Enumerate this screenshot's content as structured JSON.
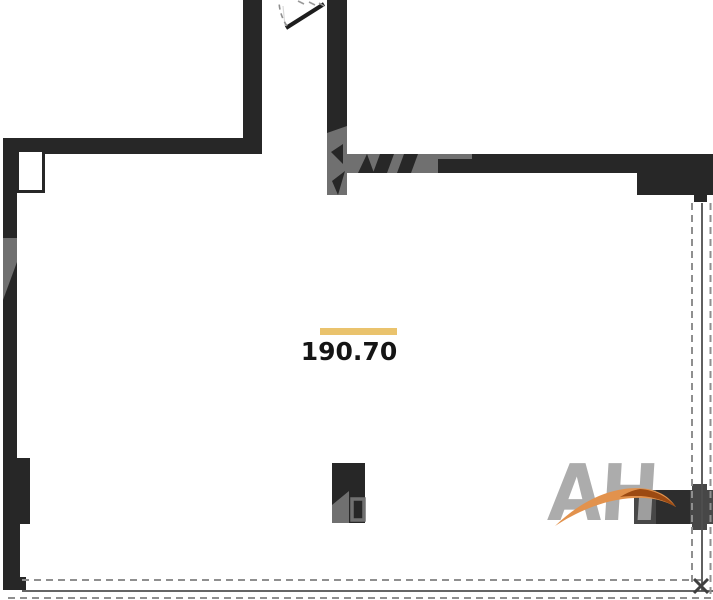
{
  "floor_plan": {
    "area_label": "190.70"
  },
  "logo": {
    "text": "АН"
  },
  "colors": {
    "wall": "#272727",
    "accent-bar": "#eac36d",
    "label-text": "#151515",
    "watermark-gray": "#707070",
    "logo-gray": "#a6a6a6",
    "swoosh-orange": "#e2924d",
    "swoosh-dark": "#9c4a12",
    "dash-gray": "#8f8f8f",
    "glazing-solid": "#4f4f4f",
    "partition-gray": "#474747",
    "partition-dark": "#2d2d2d"
  }
}
